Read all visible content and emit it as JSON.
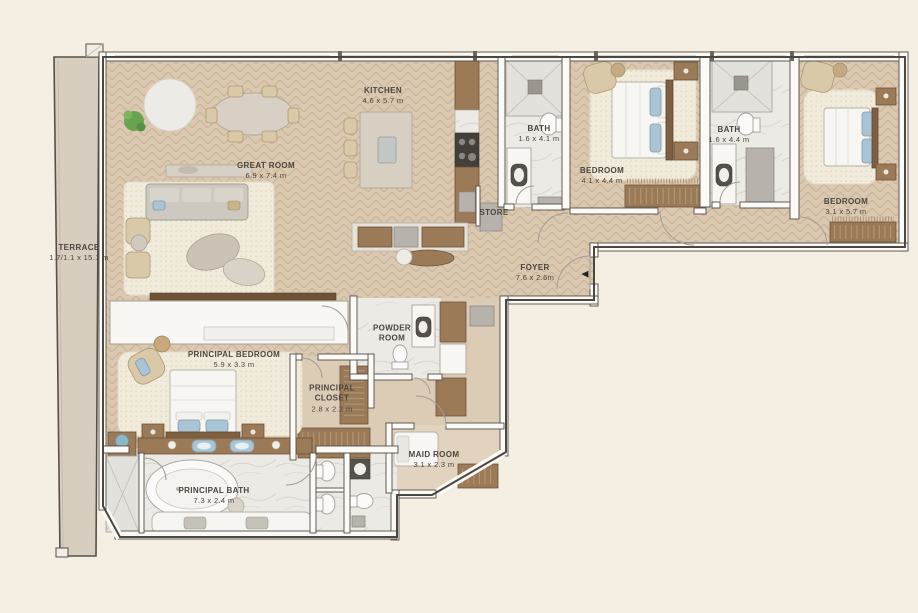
{
  "plan": {
    "type": "apartment-floor-plan",
    "entry_arrow": "◀",
    "colors": {
      "background": "#f5eee3",
      "wood_floor": "#dbc8b0",
      "plain_floor": "#dccbb5",
      "marble_floor": "#eceae5",
      "terrace_floor": "#d8cec0",
      "wall_outline": "#4c4740",
      "dark_wood": "#7f5f42",
      "rug": "#f1ebdc",
      "accent_blue": "#a9c4d4",
      "plant_green": "#69a351"
    },
    "rooms": [
      {
        "id": "terrace",
        "name": "TERRACE",
        "dims": "1.7/1.1 x 15.1 m"
      },
      {
        "id": "great-room",
        "name": "GREAT ROOM",
        "dims": "6.9 x 7.4 m"
      },
      {
        "id": "kitchen",
        "name": "KITCHEN",
        "dims": "4.6 x 5.7 m"
      },
      {
        "id": "bath-1",
        "name": "BATH",
        "dims": "1.6 x 4.1 m"
      },
      {
        "id": "bedroom-1",
        "name": "BEDROOM",
        "dims": "4.1 x 4.4 m"
      },
      {
        "id": "bath-2",
        "name": "BATH",
        "dims": "1.6 x 4.4 m"
      },
      {
        "id": "bedroom-2",
        "name": "BEDROOM",
        "dims": "3.1 x 5.7 m"
      },
      {
        "id": "store",
        "name": "STORE",
        "dims": ""
      },
      {
        "id": "foyer",
        "name": "FOYER",
        "dims": "7.6 x 2.6m"
      },
      {
        "id": "powder-room",
        "name": "POWDER ROOM",
        "dims": ""
      },
      {
        "id": "principal-bedroom",
        "name": "PRINCIPAL BEDROOM",
        "dims": "5.9 x 3.3 m"
      },
      {
        "id": "principal-closet",
        "name": "PRINCIPAL CLOSET",
        "dims": "2.8 x 2.2 m"
      },
      {
        "id": "maid-room",
        "name": "MAID ROOM",
        "dims": "3.1 x 2.3 m"
      },
      {
        "id": "principal-bath",
        "name": "PRINCIPAL BATH",
        "dims": "7.3 x 2.4 m"
      }
    ]
  }
}
